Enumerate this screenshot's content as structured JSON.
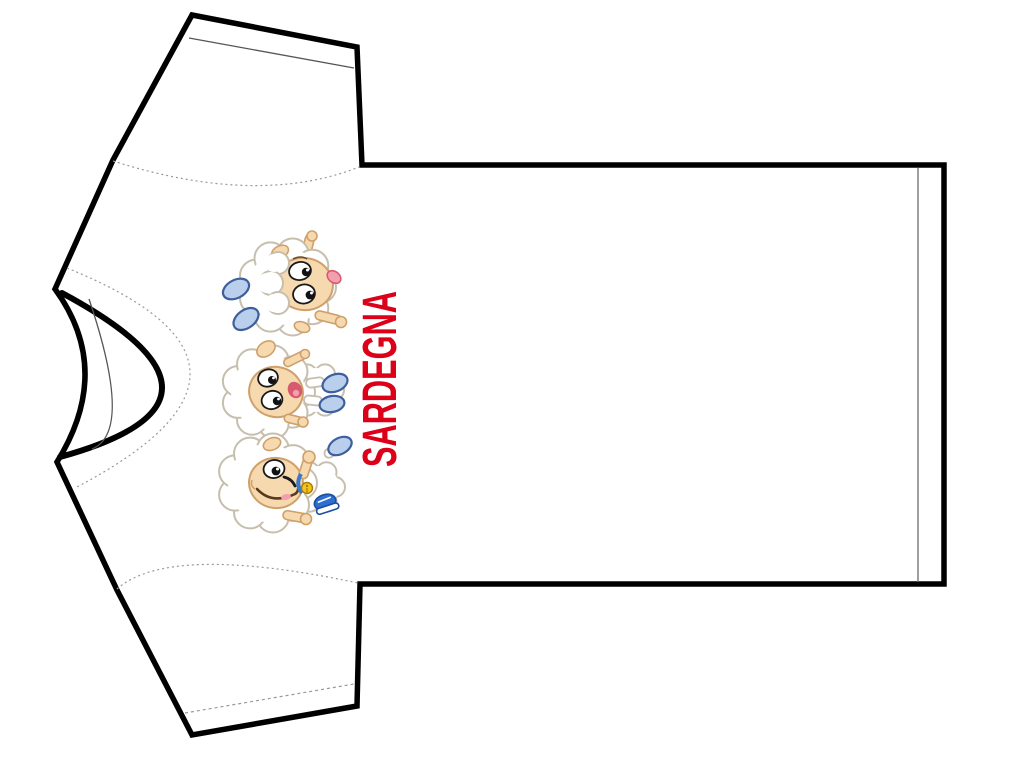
{
  "page": {
    "background": "#ffffff"
  },
  "tshirt": {
    "item": "blank t-shirt outline template shown rotated 90 degrees, collar at left",
    "fill": "#ffffff",
    "outline": "#000000"
  },
  "print": {
    "text": "SARDEGNA",
    "text_color": "#dc0019",
    "text_rotation_deg": -90,
    "mascots": [
      {
        "id": "sheep-cheering",
        "desc": "cartoon lamb with raised arm, open mouth with tongue, two pale blue hoof pads"
      },
      {
        "id": "sheep-tumbling",
        "desc": "cartoon laughing lamb stretched sideways, arms up, hoof pads kicked out"
      },
      {
        "id": "sheep-winking",
        "desc": "cartoon winking lamb with bell collar, raised fist and blue sneaker"
      }
    ]
  },
  "colors": {
    "page_bg": "#ffffff",
    "outline": "#000000",
    "seam": "#9a9a90",
    "hem_line": "#6b6b6b",
    "collar_thin": "#555555",
    "wool_outline": "#c7bfae",
    "skin": "#f7d9b0",
    "skin_outline": "#cfa06a",
    "eye_outline": "#1a1a1a",
    "brow": "#6b4a2a",
    "hoof_fill": "#b9cfec",
    "hoof_outline": "#3e5f9d",
    "sneaker": "#2e6fd0",
    "sneaker_dark": "#1c4fa0",
    "bell": "#f3c41c",
    "bell_dark": "#a87d08",
    "collar_blue": "#3a78c9",
    "tongue": "#f49fae",
    "mouth": "#d85a70",
    "smile": "#5a3a1e"
  }
}
